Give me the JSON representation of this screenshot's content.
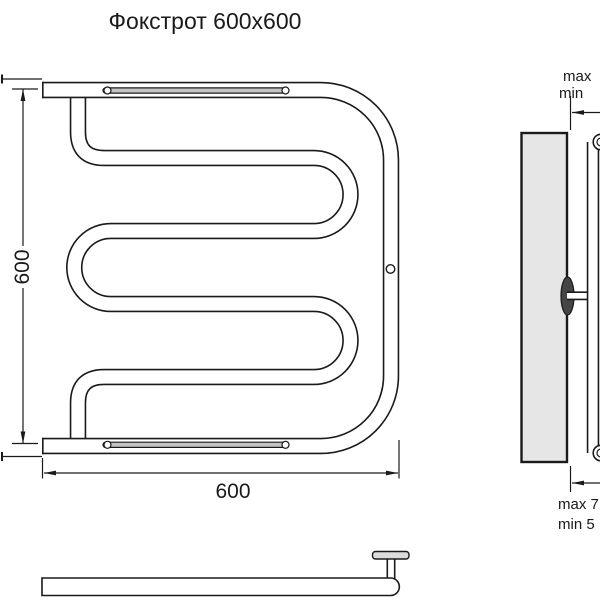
{
  "title": "Фокстрот 600x600",
  "colors": {
    "line": "#1a1a1a",
    "wall_fill": "#e6e6e6",
    "background": "#ffffff"
  },
  "front_view": {
    "height_dim": "600",
    "width_dim": "600"
  },
  "side_view": {
    "top_clearance_max": "max",
    "top_clearance_min": "min",
    "bottom_clearance_max": "max 7",
    "bottom_clearance_min": "min 5"
  }
}
